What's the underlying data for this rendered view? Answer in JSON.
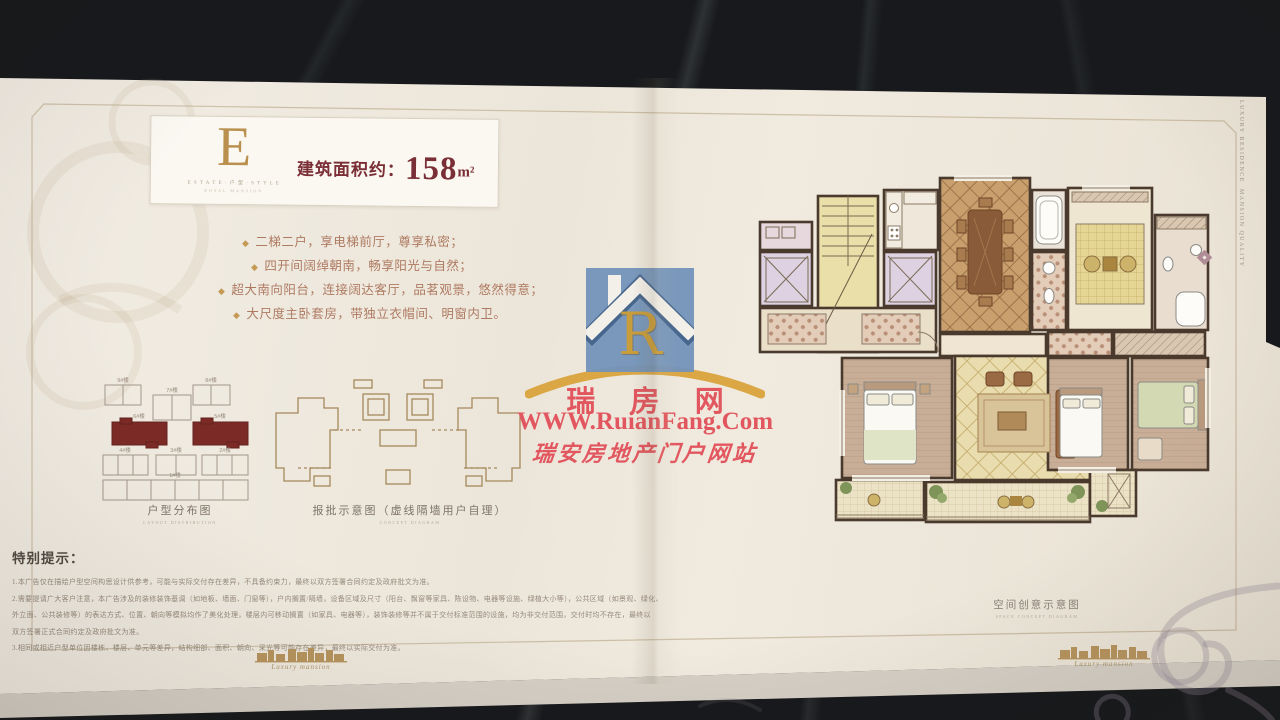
{
  "card": {
    "letter": "E",
    "letter_caption": "E S T A T E · 户 型 · S T Y L E",
    "letter_subcaption": "ROYAL MANSION",
    "area_label": "建筑面积约：",
    "area_value": "158",
    "area_unit": "m²"
  },
  "features": [
    "二梯二户，享电梯前厅，尊享私密；",
    "四开间阔绰朝南，畅享阳光与自然；",
    "超大南向阳台，连接阔达客厅，品茗观景，悠然得意；",
    "大尺度主卧套房，带独立衣帽间、明窗内卫。"
  ],
  "distribution": {
    "caption": "户型分布图",
    "caption_sub": "LAYOUT DISTRIBUTION",
    "buildings": [
      "9#楼",
      "7#楼",
      "8#楼",
      "6#楼",
      "5#楼",
      "4#楼",
      "3#楼",
      "2#楼",
      "1#楼"
    ]
  },
  "approval": {
    "caption": "报批示意图（虚线隔墙用户自理）",
    "caption_sub": "CONCEPT DIAGRAM"
  },
  "notice": {
    "title": "特别提示：",
    "lines": [
      "1.本广告仅在描绘户型空间构思设计供参考，可能与实际交付存在差异，不具备约束力，最终以双方签署合同约定及政府批文为准。",
      "2.需要提请广大客户注意，本广告涉及的装修装饰基调（如地板、墙面、门窗等），户内搁置/隔墙，设备区域及尺寸（阳台、飘窗等家具、陈设物、电器等设施、绿植大小等），公共区域（如景观、绿化、",
      "外立面、公共装修等）的表达方式、位置、朝向等模拟均作了美化处理，楼层内可移动搁置（如家具、电器等），装饰装修等并不属于交付标准范围的设施，均为非交付范围，交付时均不存在，最终以",
      "双方签署正式合同约定及政府批文为准。",
      "3.相同或相近户型单位因楼栋、楼层、单元等差异，结构细部、面积、朝向、采光等可能存在差异，最终以实际交付为准。"
    ]
  },
  "floorplan_caption": {
    "caption": "空间创意示意图",
    "caption_sub": "SPACE CONCEPT DIAGRAM"
  },
  "side_text": {
    "line1": "LUXURY RESIDENCE",
    "line2": "MANSION QUALITY"
  },
  "ornament": {
    "script": "Luxury mansion"
  },
  "watermark": {
    "logo_letter": "R",
    "site_name": "瑞 房 网",
    "url": "WWW.RuianFang.Com",
    "slogan": "瑞安房地产门户网站"
  },
  "colors": {
    "page_cream": "#efe9dd",
    "marble_black": "#17191c",
    "brand_maroon": "#7a2e35",
    "gold": "#b9904d",
    "feature_text": "#ae7a62",
    "watermark_red": "#e2575f",
    "logo_blue": "#7394bb",
    "plan_wall": "#4a3a2d",
    "highlight_building_red": "#7c2a26"
  }
}
